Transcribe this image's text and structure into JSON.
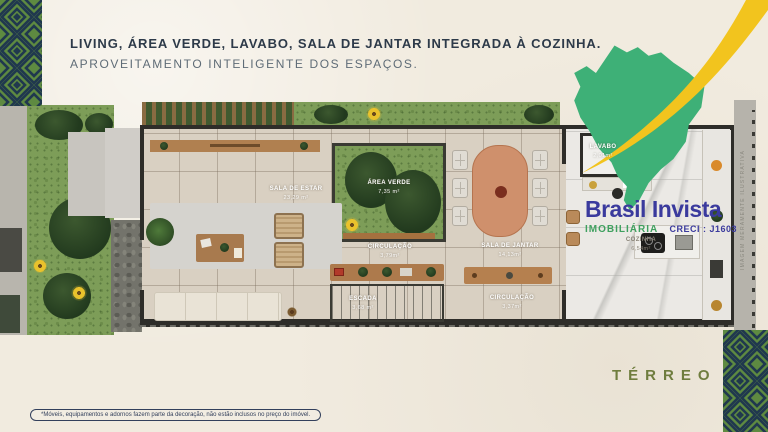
{
  "header": {
    "title": "LIVING, ÁREA VERDE, LAVABO, SALA DE JANTAR INTEGRADA À COZINHA.",
    "subtitle": "APROVEITAMENTO INTELIGENTE DOS ESPAÇOS."
  },
  "brand": {
    "name": "Brasil Invista",
    "category": "IMOBILIÁRIA",
    "creci": "CRECI : J1603"
  },
  "floorplan": {
    "watermark": "IMAGEM MERAMENTE ILUSTRATIVA",
    "rooms": [
      {
        "name": "SALA DE ESTAR",
        "area": "23,29 m²"
      },
      {
        "name": "ÁREA VERDE",
        "area": "7,35 m²"
      },
      {
        "name": "CIRCULAÇÃO",
        "area": "3,79m²"
      },
      {
        "name": "SALA DE JANTAR",
        "area": "14,13m²"
      },
      {
        "name": "ESCADA",
        "area": "3,68 m²"
      },
      {
        "name": "CIRCULAÇÃO",
        "area": "3,37m²"
      },
      {
        "name": "COZINHA",
        "area": "6,54m²"
      },
      {
        "name": "LAVABO",
        "area": "2,01m²"
      }
    ]
  },
  "footer": {
    "floor_label": "TÉRREO",
    "disclaimer": "*Móveis, equipamentos e adornos fazem parte da decoração, não estão inclusos no preço do imóvel."
  },
  "colors": {
    "paper": "#f1ebdf",
    "title_navy": "#2d3a49",
    "map_green": "#3eb077",
    "swoosh_yellow": "#f2c41e",
    "logo_blue": "#3a3a9d",
    "imobiliaria_green": "#3fa05f",
    "terreo_olive": "#6f7d3e",
    "pattern_green": "#5e8a41",
    "pattern_navy": "#20384e"
  }
}
